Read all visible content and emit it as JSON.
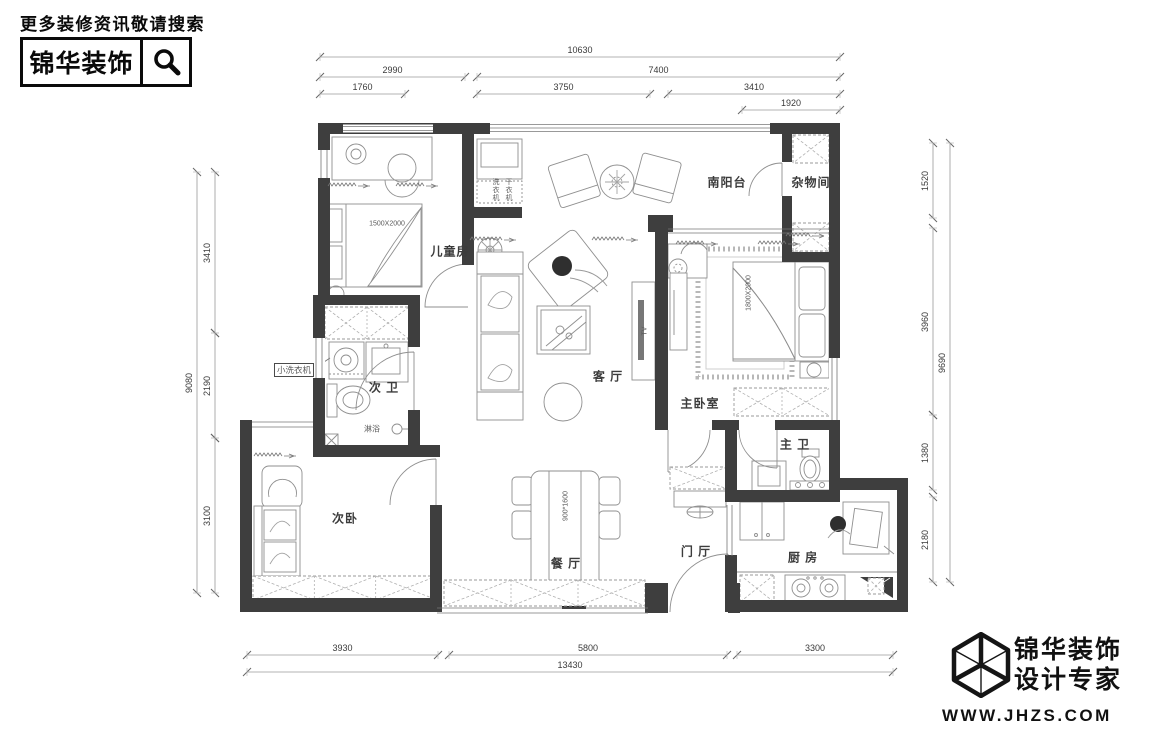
{
  "header": {
    "search_hint": "更多装修资讯敬请搜索",
    "brand": "锦华装饰"
  },
  "footer": {
    "brand": "锦华装饰",
    "tagline": "设计专家",
    "website": "WWW.JHZS.COM"
  },
  "floorplan": {
    "rooms": {
      "children": "儿童房",
      "balcony": "南阳台",
      "storage": "杂物间",
      "bath2": "次 卫",
      "living": "客 厅",
      "master": "主卧室",
      "bath1": "主 卫",
      "bed2": "次卧",
      "dining": "餐 厅",
      "entry": "门 厅",
      "kitchen": "厨 房"
    },
    "notes": {
      "shower": "淋浴",
      "small_washer": "小洗衣机",
      "washer": "洗衣机",
      "dryer": "干衣机",
      "tv": "TV",
      "children_bed_size": "1500X2000",
      "master_bed_size": "1800X2000",
      "dining_table_size": "900*1600"
    },
    "dims": {
      "top_total": "10630",
      "top_2990": "2990",
      "top_7400": "7400",
      "top_1760": "1760",
      "top_3750": "3750",
      "top_3410": "3410",
      "top_1920": "1920",
      "left_total": "9080",
      "left_3410": "3410",
      "left_2190": "2190",
      "left_3100": "3100",
      "right_1520": "1520",
      "right_3960": "3960",
      "right_1380": "1380",
      "right_2180": "2180",
      "right_total": "9690",
      "bottom_3930": "3930",
      "bottom_5800": "5800",
      "bottom_3300": "3300",
      "bottom_total": "13430"
    }
  }
}
